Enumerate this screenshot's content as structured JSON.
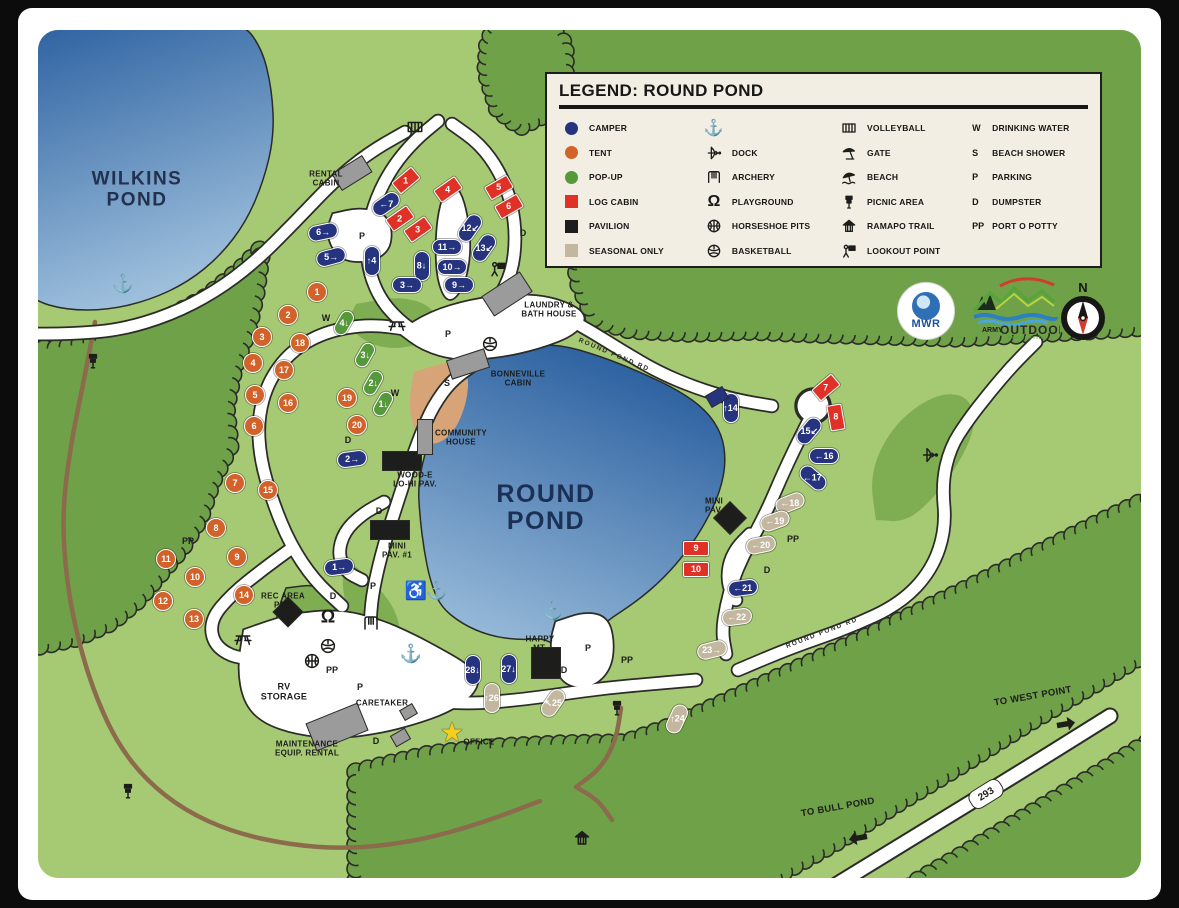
{
  "legend": {
    "title": "LEGEND: ROUND POND",
    "col1": [
      {
        "sw": "circle",
        "c": "#26337f",
        "t": "CAMPER"
      },
      {
        "sw": "circle",
        "c": "#d2622a",
        "t": "TENT"
      },
      {
        "sw": "circle",
        "c": "#55993a",
        "t": "POP-UP"
      },
      {
        "sw": "square",
        "c": "#e03127",
        "t": "LOG CABIN"
      },
      {
        "sw": "square",
        "c": "#1d1d1b",
        "t": "PAVILION"
      },
      {
        "sw": "square",
        "c": "#c3b89f",
        "t": "SEASONAL ONLY"
      }
    ],
    "col2": [
      {
        "ic": "anchor",
        "t": ""
      },
      {
        "ic": "bow",
        "t": "DOCK"
      },
      {
        "ic": "swing",
        "t": "ARCHERY"
      },
      {
        "ic": "playground",
        "t": "PLAYGROUND"
      },
      {
        "ic": "ball-cross",
        "t": "HORSESHOE PITS"
      },
      {
        "ic": "ball-panel",
        "t": "BASKETBALL"
      }
    ],
    "col3": [
      {
        "ic": "court",
        "t": "VOLLEYBALL"
      },
      {
        "ic": "gate",
        "t": "GATE"
      },
      {
        "ic": "beach",
        "t": "BEACH"
      },
      {
        "ic": "signpost",
        "t": "PICNIC AREA"
      },
      {
        "ic": "house",
        "t": "RAMAPO TRAIL"
      },
      {
        "ic": "lookout",
        "t": "LOOKOUT POINT"
      }
    ],
    "col4": [
      {
        "ab": "W",
        "t": "DRINKING WATER"
      },
      {
        "ab": "S",
        "t": "BEACH SHOWER"
      },
      {
        "ab": "P",
        "t": "PARKING"
      },
      {
        "ab": "D",
        "t": "DUMPSTER"
      },
      {
        "ab": "PP",
        "t": "PORT O POTTY"
      }
    ]
  },
  "logos": {
    "mwr": "MWR",
    "army1": "ARMY",
    "army2": "OUTDOOR",
    "army3": "RECREATION",
    "compass": "N"
  },
  "route_badge": {
    "text": "293",
    "x": 985,
    "y": 793,
    "rot": -32
  },
  "colors": {
    "camper": "#26337f",
    "tent": "#d2622a",
    "popup": "#55993a",
    "log_cabin": "#e03127",
    "pavilion": "#1d1d1b",
    "seasonal": "#c3b89f",
    "water_dark": "#2a5f9f",
    "water_light": "#9dbfdc",
    "base_green": "#a6c973",
    "forest_green": "#6fa149",
    "patch_green": "#7fae52",
    "beach_sand": "#d7a478",
    "trail_brown": "#8b6b4c",
    "road_white": "#ffffff",
    "outline": "#2b2b28",
    "legend_bg": "#f3eee3"
  },
  "labels": [
    {
      "t": "WILKINS\nPOND",
      "x": 137,
      "y": 190,
      "s": 19,
      "c": "#23304e",
      "cls": "pond-label"
    },
    {
      "t": "ROUND\nPOND",
      "x": 546,
      "y": 508,
      "s": 25,
      "c": "#1c2f55",
      "cls": "pond-label"
    },
    {
      "t": "RENTAL\nCABIN",
      "x": 326,
      "y": 179,
      "s": 8
    },
    {
      "t": "LAUNDRY &\nBATH HOUSE",
      "x": 549,
      "y": 310,
      "s": 8
    },
    {
      "t": "BONNEVILLE\nCABIN",
      "x": 518,
      "y": 379,
      "s": 8
    },
    {
      "t": "COMMUNITY\nHOUSE",
      "x": 461,
      "y": 438,
      "s": 8
    },
    {
      "t": "WOOD-E\nLO-HI PAV.",
      "x": 415,
      "y": 480,
      "s": 8
    },
    {
      "t": "MINI\nPAV. #1",
      "x": 397,
      "y": 551,
      "s": 8
    },
    {
      "t": "REC AREA\nPAV.",
      "x": 283,
      "y": 601,
      "s": 8
    },
    {
      "t": "MINI\nPAV.",
      "x": 714,
      "y": 506,
      "s": 8
    },
    {
      "t": "RV\nSTORAGE",
      "x": 284,
      "y": 692,
      "s": 9
    },
    {
      "t": "CARETAKER",
      "x": 382,
      "y": 704,
      "s": 8
    },
    {
      "t": "MAINTENANCE\nEQUIP. RENTAL",
      "x": 307,
      "y": 749,
      "s": 8
    },
    {
      "t": "OFFICE",
      "x": 479,
      "y": 743,
      "s": 8
    },
    {
      "t": "HAPPY\nMT.",
      "x": 540,
      "y": 644,
      "s": 8
    },
    {
      "t": "TO WEST POINT",
      "x": 1033,
      "y": 697,
      "s": 9.5,
      "rot": -10
    },
    {
      "t": "TO BULL POND",
      "x": 838,
      "y": 808,
      "s": 9.5,
      "rot": -10
    }
  ],
  "road_names": [
    {
      "t": "ROUND POND RD",
      "x": 614,
      "y": 355,
      "s": 6.5,
      "rot": 23
    },
    {
      "t": "ROUND POND RD",
      "x": 822,
      "y": 633,
      "s": 6.5,
      "rot": -21
    }
  ],
  "letters": [
    {
      "t": "P",
      "x": 362,
      "y": 236
    },
    {
      "t": "P",
      "x": 448,
      "y": 334
    },
    {
      "t": "P",
      "x": 373,
      "y": 586
    },
    {
      "t": "P",
      "x": 360,
      "y": 687
    },
    {
      "t": "P",
      "x": 588,
      "y": 648
    },
    {
      "t": "PP",
      "x": 627,
      "y": 660
    },
    {
      "t": "PP",
      "x": 332,
      "y": 670
    },
    {
      "t": "PP",
      "x": 188,
      "y": 541
    },
    {
      "t": "PP",
      "x": 793,
      "y": 539
    },
    {
      "t": "D",
      "x": 523,
      "y": 233
    },
    {
      "t": "D",
      "x": 348,
      "y": 440
    },
    {
      "t": "D",
      "x": 379,
      "y": 511
    },
    {
      "t": "D",
      "x": 333,
      "y": 596
    },
    {
      "t": "D",
      "x": 376,
      "y": 741
    },
    {
      "t": "D",
      "x": 564,
      "y": 670
    },
    {
      "t": "D",
      "x": 767,
      "y": 570
    },
    {
      "t": "W",
      "x": 326,
      "y": 318
    },
    {
      "t": "W",
      "x": 395,
      "y": 393
    },
    {
      "t": "S",
      "x": 447,
      "y": 383
    }
  ],
  "icons": [
    {
      "k": "anchor",
      "x": 123,
      "y": 284
    },
    {
      "k": "anchor",
      "x": 437,
      "y": 591
    },
    {
      "k": "anchor",
      "x": 411,
      "y": 654
    },
    {
      "k": "anchor",
      "x": 553,
      "y": 611
    },
    {
      "k": "wheelchair",
      "x": 416,
      "y": 591
    },
    {
      "k": "court",
      "x": 415,
      "y": 127
    },
    {
      "k": "picnic-table",
      "x": 397,
      "y": 325
    },
    {
      "k": "picnic-table",
      "x": 243,
      "y": 639
    },
    {
      "k": "ball-panel",
      "x": 490,
      "y": 344
    },
    {
      "k": "ball-panel",
      "x": 328,
      "y": 646
    },
    {
      "k": "ball-cross",
      "x": 312,
      "y": 661
    },
    {
      "k": "playground",
      "x": 328,
      "y": 617
    },
    {
      "k": "swing",
      "x": 371,
      "y": 623
    },
    {
      "k": "lookout",
      "x": 498,
      "y": 269
    },
    {
      "k": "bow",
      "x": 930,
      "y": 455
    },
    {
      "k": "house",
      "x": 582,
      "y": 838
    },
    {
      "k": "signpost",
      "x": 93,
      "y": 361
    },
    {
      "k": "signpost",
      "x": 128,
      "y": 791
    },
    {
      "k": "signpost",
      "x": 617,
      "y": 708
    },
    {
      "k": "star",
      "x": 452,
      "y": 733
    },
    {
      "k": "arrow-right",
      "x": 1066,
      "y": 724,
      "rot": -10
    },
    {
      "k": "arrow-left",
      "x": 858,
      "y": 838,
      "rot": -10
    }
  ],
  "sites": {
    "campers": [
      {
        "t": "←7",
        "x": 386,
        "y": 204,
        "r": -35
      },
      {
        "t": "6→",
        "x": 323,
        "y": 232,
        "r": -12
      },
      {
        "t": "5→",
        "x": 331,
        "y": 257,
        "r": -15
      },
      {
        "t": "↑4",
        "x": 372,
        "y": 261,
        "r": 90
      },
      {
        "t": "8↓",
        "x": 422,
        "y": 266,
        "r": 90
      },
      {
        "t": "3→",
        "x": 407,
        "y": 285,
        "r": 0
      },
      {
        "t": "11→",
        "x": 447,
        "y": 247,
        "r": 0
      },
      {
        "t": "10→",
        "x": 452,
        "y": 267,
        "r": 0
      },
      {
        "t": "9→",
        "x": 459,
        "y": 285,
        "r": 0
      },
      {
        "t": "12↙",
        "x": 470,
        "y": 228,
        "r": -55
      },
      {
        "t": "13↙",
        "x": 484,
        "y": 248,
        "r": -55
      },
      {
        "t": "2→",
        "x": 352,
        "y": 459,
        "r": -8
      },
      {
        "t": "1→",
        "x": 339,
        "y": 567,
        "r": -8
      },
      {
        "t": "↑14",
        "x": 731,
        "y": 408,
        "r": 90
      },
      {
        "t": "15↙",
        "x": 809,
        "y": 431,
        "r": -50
      },
      {
        "t": "←16",
        "x": 824,
        "y": 456,
        "r": 0
      },
      {
        "t": "←17",
        "x": 813,
        "y": 478,
        "r": 40
      },
      {
        "t": "←21",
        "x": 743,
        "y": 588,
        "r": -8
      },
      {
        "t": "27↓",
        "x": 509,
        "y": 669,
        "r": 90
      },
      {
        "t": "28↓",
        "x": 473,
        "y": 670,
        "r": 90
      }
    ],
    "tents": [
      {
        "t": "1",
        "x": 317,
        "y": 292
      },
      {
        "t": "2",
        "x": 288,
        "y": 315
      },
      {
        "t": "3",
        "x": 262,
        "y": 337
      },
      {
        "t": "4",
        "x": 253,
        "y": 363
      },
      {
        "t": "5",
        "x": 255,
        "y": 395
      },
      {
        "t": "6",
        "x": 254,
        "y": 426
      },
      {
        "t": "7",
        "x": 235,
        "y": 483
      },
      {
        "t": "8",
        "x": 216,
        "y": 528
      },
      {
        "t": "9",
        "x": 237,
        "y": 557
      },
      {
        "t": "10",
        "x": 195,
        "y": 577
      },
      {
        "t": "11",
        "x": 166,
        "y": 559
      },
      {
        "t": "12",
        "x": 163,
        "y": 601
      },
      {
        "t": "13",
        "x": 194,
        "y": 619
      },
      {
        "t": "14",
        "x": 244,
        "y": 595
      },
      {
        "t": "15",
        "x": 268,
        "y": 490
      },
      {
        "t": "16",
        "x": 288,
        "y": 403
      },
      {
        "t": "17",
        "x": 284,
        "y": 370
      },
      {
        "t": "18",
        "x": 300,
        "y": 343
      },
      {
        "t": "19",
        "x": 347,
        "y": 398
      },
      {
        "t": "20",
        "x": 357,
        "y": 425
      }
    ],
    "popups": [
      {
        "t": "4↓",
        "x": 344,
        "y": 323,
        "r": -60
      },
      {
        "t": "3↓",
        "x": 365,
        "y": 355,
        "r": -60
      },
      {
        "t": "2↓",
        "x": 373,
        "y": 383,
        "r": -60
      },
      {
        "t": "1↓",
        "x": 383,
        "y": 404,
        "r": -60
      }
    ],
    "cabins": [
      {
        "t": "1",
        "x": 406,
        "y": 180,
        "r": -40
      },
      {
        "t": "2",
        "x": 400,
        "y": 218,
        "r": -35
      },
      {
        "t": "3",
        "x": 418,
        "y": 229,
        "r": -35
      },
      {
        "t": "4",
        "x": 448,
        "y": 189,
        "r": -35
      },
      {
        "t": "5",
        "x": 499,
        "y": 187,
        "r": -30
      },
      {
        "t": "6",
        "x": 509,
        "y": 206,
        "r": -30
      },
      {
        "t": "7",
        "x": 826,
        "y": 387,
        "r": -40
      },
      {
        "t": "8",
        "x": 836,
        "y": 417,
        "r": 80
      },
      {
        "t": "9",
        "x": 696,
        "y": 548,
        "r": 0
      },
      {
        "t": "10",
        "x": 696,
        "y": 569,
        "r": 0
      }
    ],
    "seasonal": [
      {
        "t": "←18",
        "x": 790,
        "y": 503,
        "r": -22
      },
      {
        "t": "←19",
        "x": 775,
        "y": 521,
        "r": -20
      },
      {
        "t": "←20",
        "x": 761,
        "y": 545,
        "r": -12
      },
      {
        "t": "←22",
        "x": 737,
        "y": 617,
        "r": -8
      },
      {
        "t": "23→",
        "x": 712,
        "y": 650,
        "r": -14
      },
      {
        "t": "↑24",
        "x": 677,
        "y": 719,
        "r": -65
      },
      {
        "t": "↖25",
        "x": 553,
        "y": 703,
        "r": -55
      },
      {
        "t": "↑26",
        "x": 492,
        "y": 698,
        "r": 90
      }
    ]
  },
  "pavilions": [
    {
      "x": 402,
      "y": 461,
      "w": 40,
      "h": 20,
      "r": 0,
      "n": "wood-e-lo-hi-pavilion"
    },
    {
      "x": 390,
      "y": 530,
      "w": 40,
      "h": 20,
      "r": 0,
      "n": "mini-pavilion-1"
    },
    {
      "x": 546,
      "y": 663,
      "w": 30,
      "h": 32,
      "r": 0,
      "n": "happy-mt-pavilion"
    },
    {
      "x": 288,
      "y": 612,
      "w": 22,
      "h": 22,
      "r": 45,
      "n": "rec-area-pavilion"
    },
    {
      "x": 730,
      "y": 518,
      "w": 24,
      "h": 24,
      "r": 45,
      "n": "mini-pavilion"
    }
  ],
  "buildings": [
    {
      "x": 352,
      "y": 173,
      "w": 36,
      "h": 20,
      "r": -32,
      "n": "rental-cabin"
    },
    {
      "x": 507,
      "y": 294,
      "w": 46,
      "h": 24,
      "r": -33,
      "n": "laundry-bath-house"
    },
    {
      "x": 468,
      "y": 364,
      "w": 40,
      "h": 20,
      "r": -18,
      "n": "bonneville-cabin"
    },
    {
      "x": 425,
      "y": 437,
      "w": 16,
      "h": 36,
      "r": 0,
      "n": "community-house"
    },
    {
      "x": 337,
      "y": 727,
      "w": 56,
      "h": 30,
      "r": -22,
      "n": "maintenance-building"
    },
    {
      "x": 408,
      "y": 712,
      "w": 15,
      "h": 12,
      "r": -30,
      "n": "caretaker-shed"
    },
    {
      "x": 400,
      "y": 737,
      "w": 17,
      "h": 13,
      "r": -30,
      "n": "caretaker-shed"
    },
    {
      "x": 717,
      "y": 397,
      "w": 20,
      "h": 14,
      "r": -30,
      "n": "dock-square",
      "c": "#26337f"
    }
  ]
}
